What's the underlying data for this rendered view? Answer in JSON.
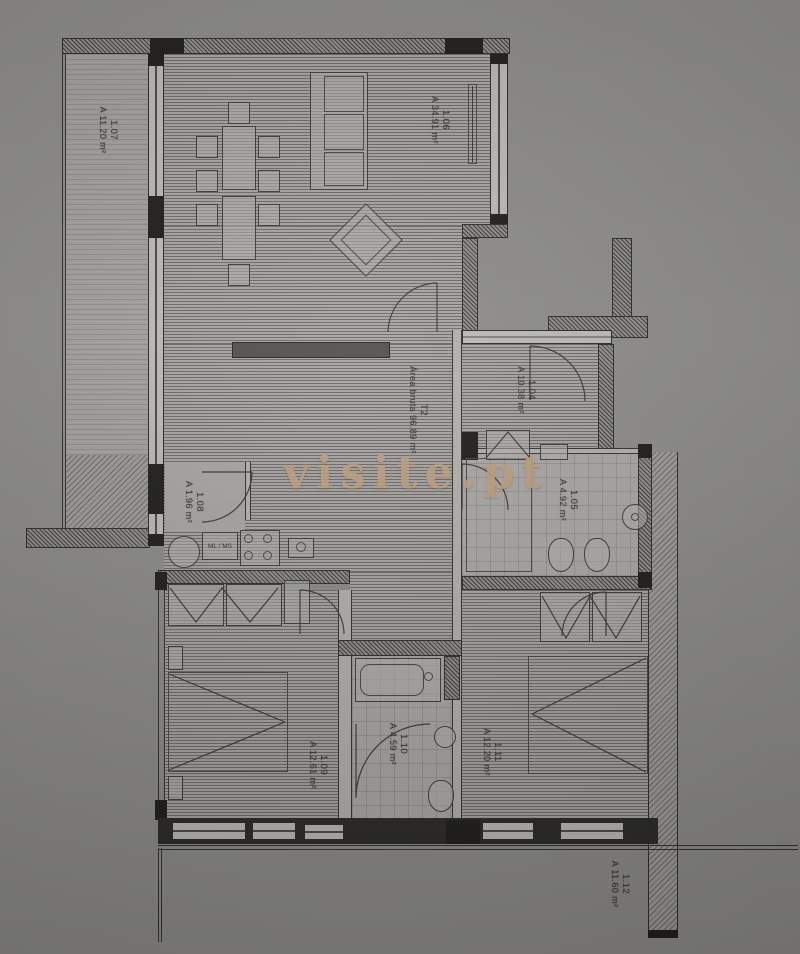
{
  "watermark": "visite.pt",
  "plan": {
    "type_label": "T2",
    "gross_area_label": "Área bruta 96.89 m²",
    "rooms": [
      {
        "id": "1.07",
        "area": "A 11.20 m²"
      },
      {
        "id": "1.06",
        "area": "A 34.91 m²"
      },
      {
        "id": "1.04",
        "area": "A 10.38 m²"
      },
      {
        "id": "1.08",
        "area": "A 1.96 m²"
      },
      {
        "id": "1.05",
        "area": "A 4.92 m²"
      },
      {
        "id": "1.09",
        "area": "A 12.61 m²"
      },
      {
        "id": "1.10",
        "area": "A 4.59 m²"
      },
      {
        "id": "1.11",
        "area": "A 12.20 m²"
      },
      {
        "id": "1.12",
        "area": "A 11.60 m²"
      }
    ],
    "labels": {
      "appliances": "ML / MS"
    },
    "colors": {
      "paper": "#8d8c8a",
      "ink": "#2e2d2b",
      "watermark": "#c2a381"
    }
  }
}
